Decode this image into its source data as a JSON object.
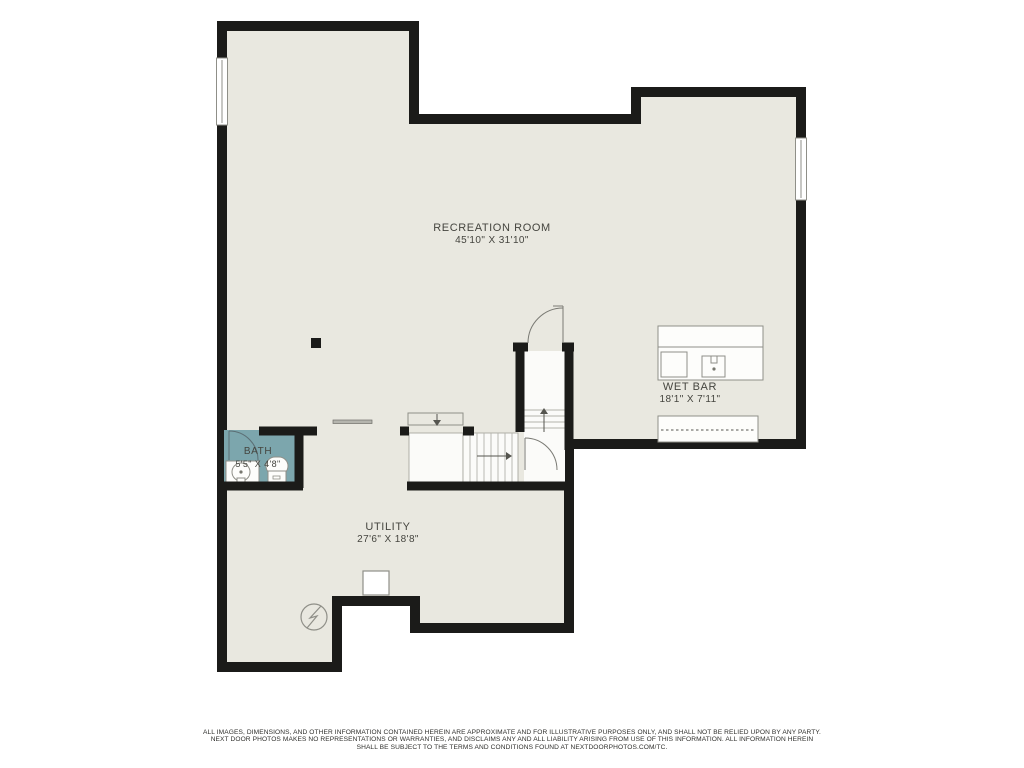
{
  "rooms": {
    "recreation": {
      "name": "RECREATION ROOM",
      "dimensions": "45'10\" X 31'10\""
    },
    "wet_bar": {
      "name": "WET BAR",
      "dimensions": "18'1\" X 7'11\""
    },
    "bath": {
      "name": "BATH",
      "dimensions": "5'5\" X 4'8\""
    },
    "utility": {
      "name": "UTILITY",
      "dimensions": "27'6\" X 18'8\""
    }
  },
  "icons": {
    "electrical_panel": "circle-lightning",
    "furnace": "outlined-square",
    "support_post": "filled-square",
    "stair_up_arrow": "arrow-up",
    "stair_down_arrow": "arrow-down",
    "stair_right_arrow": "arrow-right",
    "window_count": 2,
    "door_count": 3
  },
  "colors": {
    "floor": "#e9e8e0",
    "wall": "#1b1b19",
    "bath": "#7ca6ad",
    "line": "#8f8f88",
    "text": "#45453f"
  },
  "disclaimer": {
    "line1": "ALL IMAGES, DIMENSIONS, AND OTHER INFORMATION CONTAINED HEREIN ARE APPROXIMATE AND FOR ILLUSTRATIVE PURPOSES ONLY, AND SHALL NOT BE RELIED UPON BY ANY PARTY.",
    "line2": "NEXT DOOR PHOTOS MAKES NO REPRESENTATIONS OR WARRANTIES, AND DISCLAIMS ANY AND ALL LIABILITY ARISING FROM USE OF THIS INFORMATION. ALL INFORMATION HEREIN",
    "line3": "SHALL BE SUBJECT TO THE TERMS AND CONDITIONS FOUND AT NEXTDOORPHOTOS.COM/TC."
  }
}
